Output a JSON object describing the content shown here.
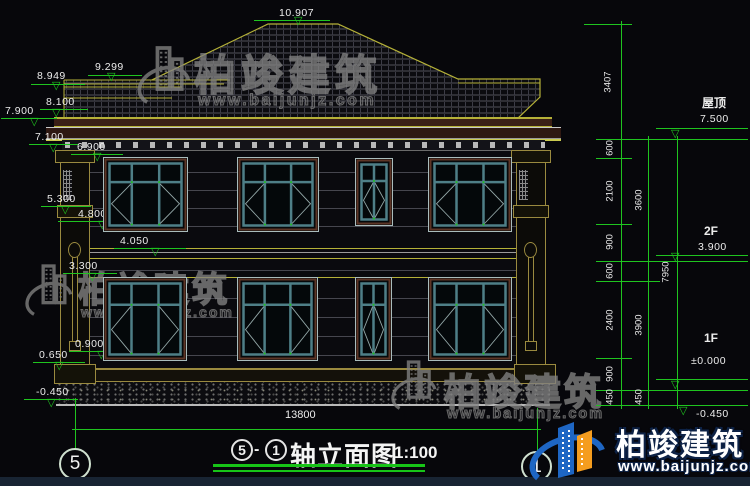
{
  "drawing_title": {
    "axis_from": "5",
    "separator": "-",
    "axis_to": "1",
    "name": "轴立面图",
    "scale": "1:100"
  },
  "elevations": {
    "peak": "10.907",
    "left": [
      "9.299",
      "8.949",
      "8.100",
      "7.900",
      "7.100",
      "6.900",
      "5.300",
      "4.800",
      "4.050",
      "3.300",
      "0.900",
      "0.650",
      "-0.450"
    ],
    "right": [
      {
        "label": "屋顶",
        "value": "7.500"
      },
      {
        "label": "2F",
        "value": "3.900"
      },
      {
        "label": "1F",
        "value": "±0.000"
      },
      {
        "label": "",
        "value": "-0.450"
      }
    ]
  },
  "dimensions": {
    "right_top": "3407",
    "right_inner": [
      "600",
      "2100",
      "900",
      "600",
      "2400",
      "900",
      "450"
    ],
    "right_middle": [
      "3600",
      "3900",
      "450"
    ],
    "right_outer": "7950",
    "bottom_total": "13800"
  },
  "axes": {
    "left": "5",
    "right": "1"
  },
  "watermark": {
    "brand": "柏竣建筑",
    "url": "www.baijunjz.com"
  },
  "logo": {
    "brand": "柏竣建筑",
    "url": "www.baijunjz.com"
  },
  "colors": {
    "background": "#07070b",
    "dim_green": "#1fc41f",
    "text_white": "#ececec",
    "roof_yellow": "#b5b138",
    "frame_teal": "#4e7f87",
    "frame_maroon": "#5d3526",
    "logo_blue": "#1e66c4",
    "logo_orange": "#f59d1f"
  }
}
